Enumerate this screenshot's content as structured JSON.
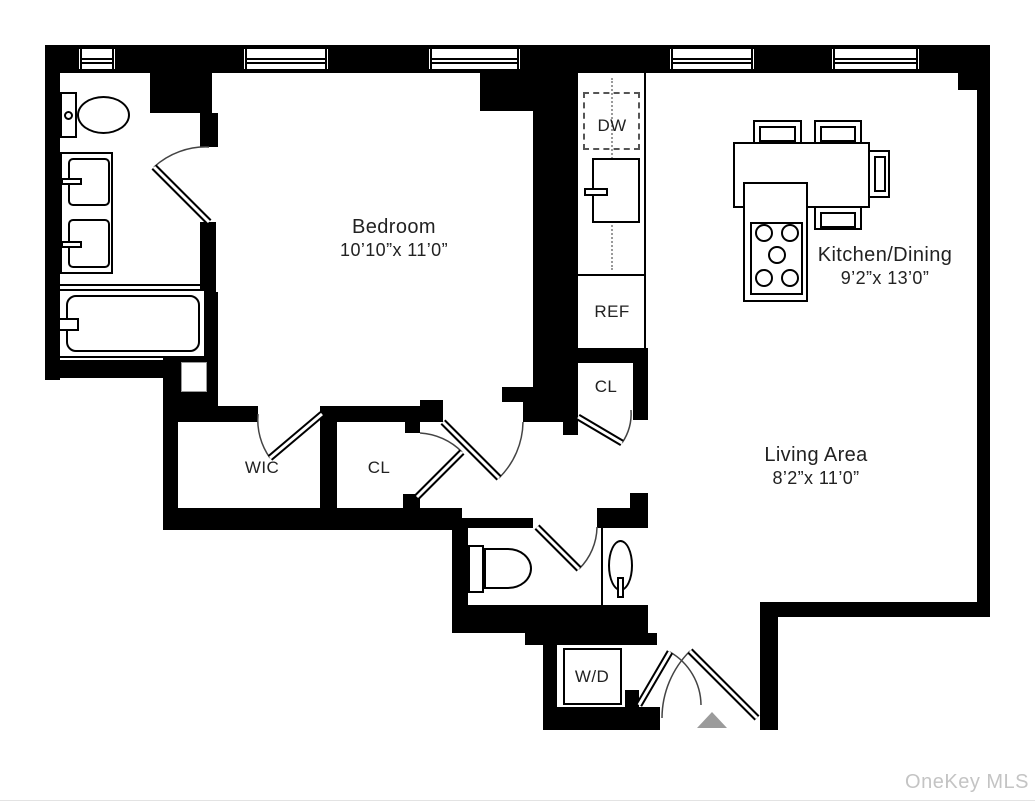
{
  "watermark": "OneKey MLS",
  "rooms": {
    "bedroom": {
      "name": "Bedroom",
      "dims": "10’10”x 11’0”"
    },
    "kitchen_dining": {
      "name": "Kitchen/Dining",
      "dims": "9’2”x 13’0”"
    },
    "living_area": {
      "name": "Living Area",
      "dims": "8’2”x 11’0”"
    },
    "wic": {
      "label": "WIC"
    },
    "closet_hall": {
      "label": "CL"
    },
    "closet_kitchen": {
      "label": "CL"
    }
  },
  "appliances": {
    "dishwasher": "DW",
    "refrigerator": "REF",
    "washer_dryer": "W/D"
  },
  "colors": {
    "wall": "#000000",
    "text": "#222222",
    "entry_marker": "#9b9b9b",
    "watermark": "#c4c4c4"
  }
}
